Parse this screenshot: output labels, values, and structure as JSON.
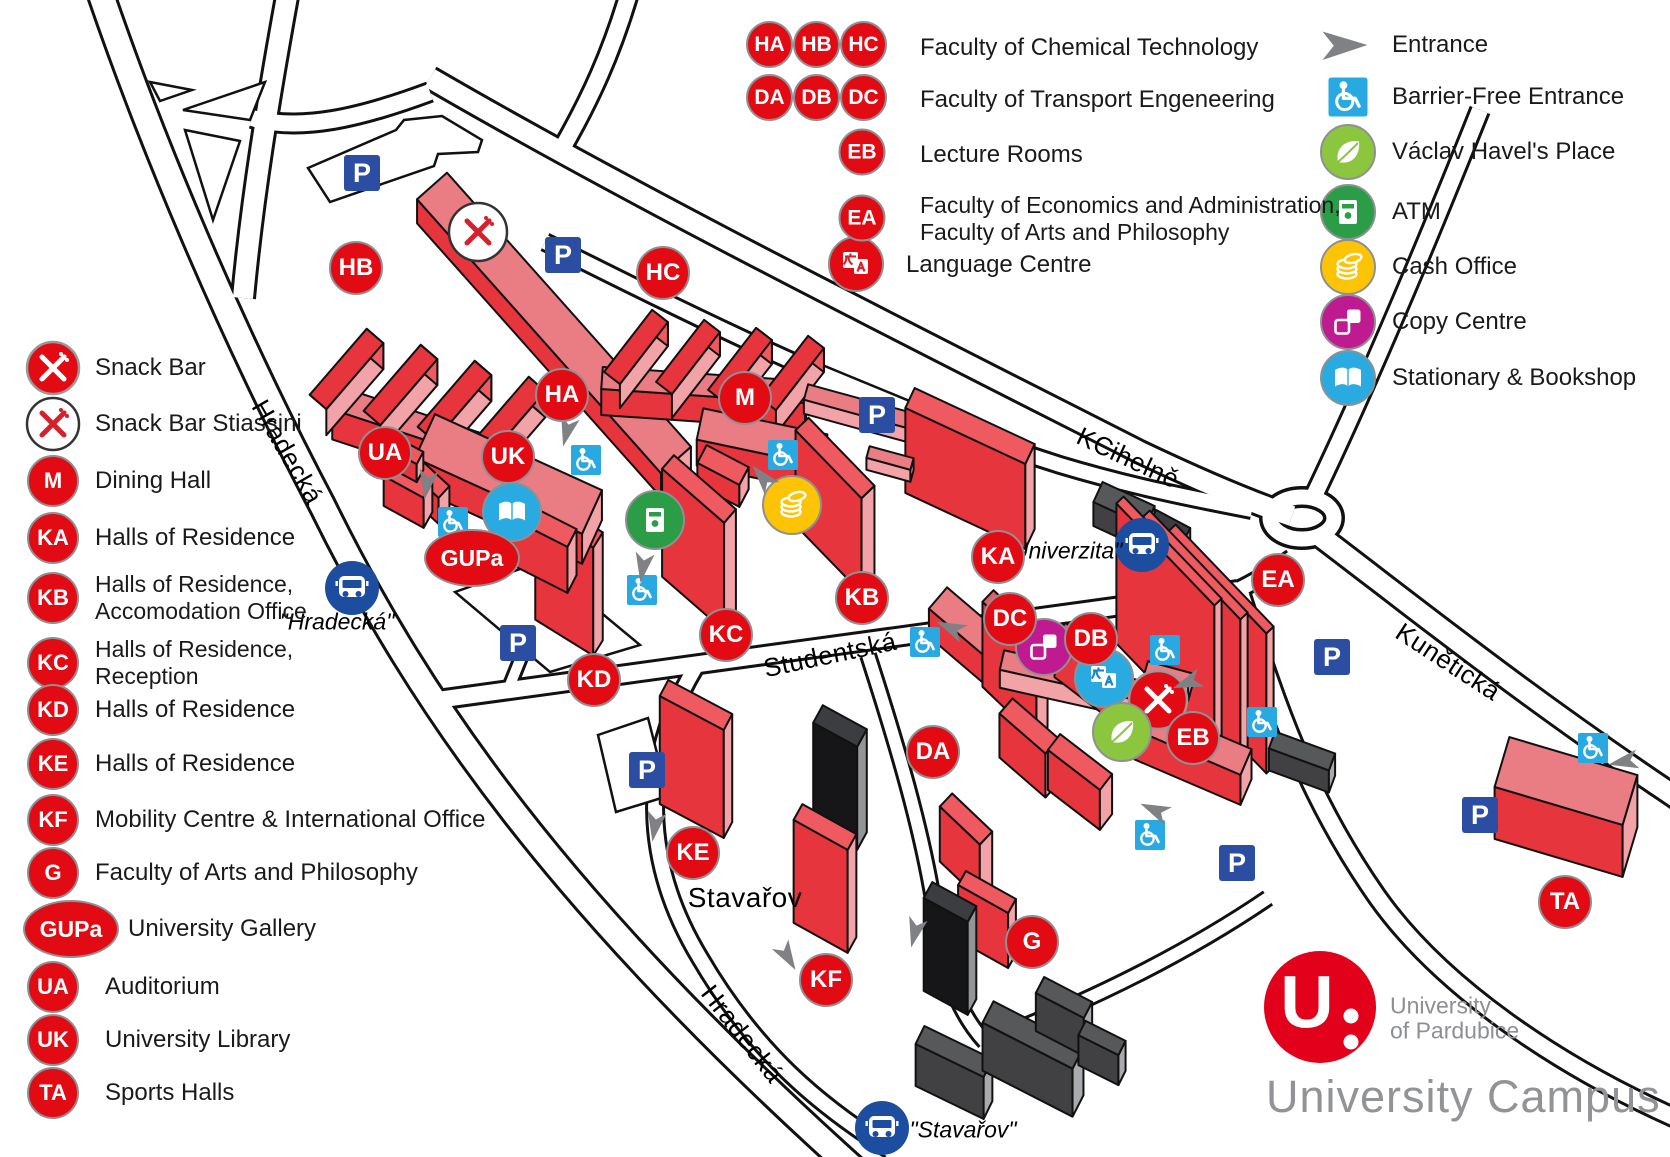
{
  "app": {
    "logo_letter": "U",
    "org_line1": "University",
    "org_line2": "of Pardubice",
    "caption": "University Campus"
  },
  "legend_left": [
    {
      "label": "Snack Bar"
    },
    {
      "label": "Snack Bar Stiassini"
    },
    {
      "badge": "M",
      "label": "Dining Hall"
    },
    {
      "badge": "KA",
      "label": "Halls of Residence"
    },
    {
      "badge": "KB",
      "label": "Halls of Residence,",
      "label2": "Accomodation Office"
    },
    {
      "badge": "KC",
      "label": "Halls of Residence,",
      "label2": "Reception"
    },
    {
      "badge": "KD",
      "label": "Halls of Residence"
    },
    {
      "badge": "KE",
      "label": "Halls of Residence"
    },
    {
      "badge": "KF",
      "label": "Mobility Centre & International Office"
    },
    {
      "badge": "G",
      "label": "Faculty of Arts and Philosophy"
    },
    {
      "badge": "GUPa",
      "label": "University Gallery"
    },
    {
      "badge": "UA",
      "label": "Auditorium"
    },
    {
      "badge": "UK",
      "label": "University Library"
    },
    {
      "badge": "TA",
      "label": "Sports Halls"
    }
  ],
  "legend_top": [
    {
      "badges": [
        "HA",
        "HB",
        "HC"
      ],
      "label": "Faculty of Chemical Technology"
    },
    {
      "badges": [
        "DA",
        "DB",
        "DC"
      ],
      "label": "Faculty of Transport Engeneering"
    },
    {
      "badges": [
        "EB"
      ],
      "label": "Lecture Rooms"
    },
    {
      "badges": [
        "EA"
      ],
      "label": "Faculty of Economics and Administration,",
      "label2": "Faculty of Arts and Philosophy"
    },
    {
      "label": "Language Centre"
    }
  ],
  "legend_right": [
    {
      "label": "Entrance"
    },
    {
      "label": "Barrier-Free Entrance"
    },
    {
      "label": "Václav Havel's Place"
    },
    {
      "label": "ATM"
    },
    {
      "label": "Cash Office"
    },
    {
      "label": "Copy Centre"
    },
    {
      "label": "Stationary & Bookshop"
    }
  ],
  "map": {
    "badges": {
      "hb": "HB",
      "hc": "HC",
      "ha": "HA",
      "m": "M",
      "ua": "UA",
      "uk": "UK",
      "gupa": "GUPa",
      "ka": "KA",
      "kb": "KB",
      "kc": "KC",
      "kd": "KD",
      "dc": "DC",
      "db": "DB",
      "da": "DA",
      "eb": "EB",
      "ea": "EA",
      "ke": "KE",
      "kf": "KF",
      "g": "G",
      "ta": "TA"
    },
    "streets": {
      "hradecka_top": "Hradecká",
      "hradecka_bottom": "Hradecká",
      "studentska": "Studentská",
      "k_cihelne": "KCihelně",
      "kuneticka": "Kunětická",
      "stavarov": "Stavařov"
    },
    "bus_stops": {
      "hradecka": "\"Hradecká\"",
      "univerzita": "\"Univerzita\"",
      "stavarov": "\"Stavařov\""
    },
    "parking_label": "P"
  },
  "colors": {
    "badge_red": "#e30b13",
    "building_red": "#e6353c",
    "building_pink": "#f2a3a7",
    "building_salmon": "#e97d83",
    "parking_blue": "#2b4ea2",
    "bus_blue": "#1c4d9f",
    "barrier_blue": "#29a9e1",
    "book_blue": "#29abe2",
    "atm_green": "#2a9d46",
    "leaf_green": "#8cc63e",
    "cash_yellow": "#fcc405",
    "copy_magenta": "#c01a90",
    "entrance_gray": "#808184",
    "gray_building": "#57585a",
    "black_building": "#161618",
    "logo_red": "#e2001a",
    "caption_gray": "#919396"
  }
}
